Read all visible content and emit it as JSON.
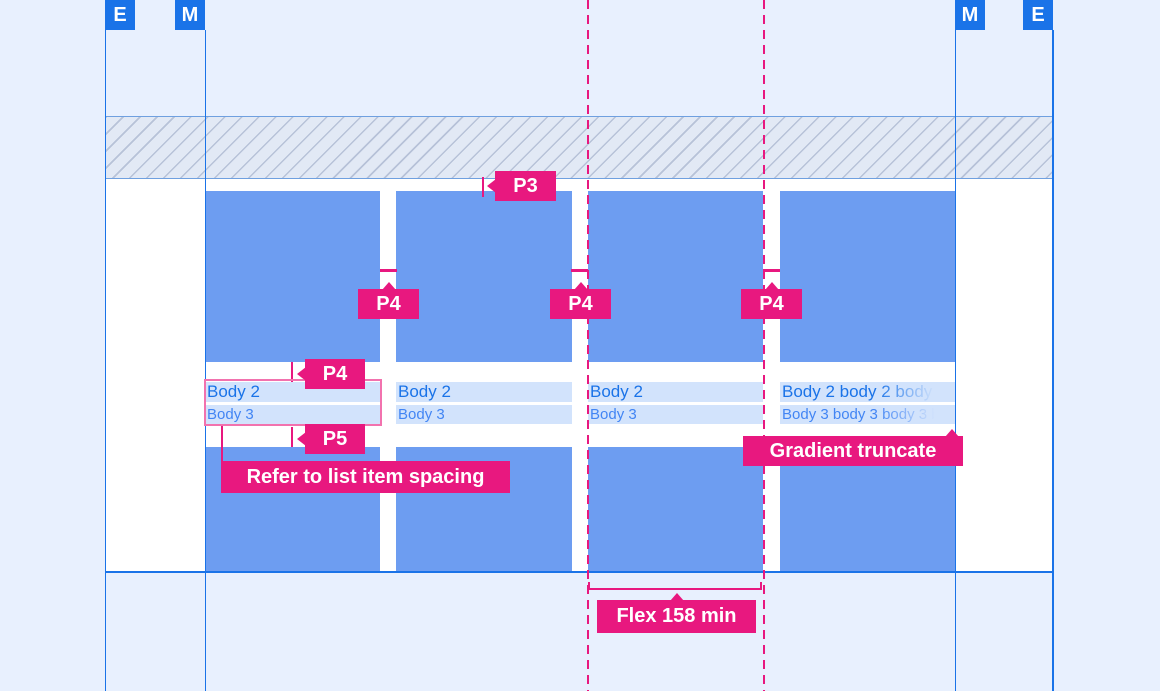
{
  "colors": {
    "bg": "#E8F0FE",
    "blue": "#1A73E8",
    "card": "#6D9DF1",
    "band": "#D2E3FC",
    "body2Text": "#1A73E8",
    "body3Text": "#4285F4",
    "pink": "#E8187F",
    "pinkLight": "#F272AE",
    "hatchBg": "#E2E9F5",
    "hatchLine": "#B7C2D8",
    "hatchBorder": "#6FA0E0"
  },
  "margin_markers": {
    "left_outer": "E",
    "left_inner": "M",
    "right_inner": "M",
    "right_outer": "E"
  },
  "cards": [
    {
      "line1": "Body 2",
      "line2": "Body 3"
    },
    {
      "line1": "Body 2",
      "line2": "Body 3"
    },
    {
      "line1": "Body 2",
      "line2": "Body 3"
    },
    {
      "line1": "Body 2 body 2 body 2 body 2",
      "line2": "Body 3 body 3 body 3 body 3"
    }
  ],
  "annotations": {
    "p3": "P3",
    "p4_gap_1": "P4",
    "p4_gap_2": "P4",
    "p4_gap_3": "P4",
    "p4_text": "P4",
    "p5_text": "P5",
    "refer": "Refer to list item spacing",
    "gradient_truncate": "Gradient truncate",
    "flex_min": "Flex 158 min"
  }
}
